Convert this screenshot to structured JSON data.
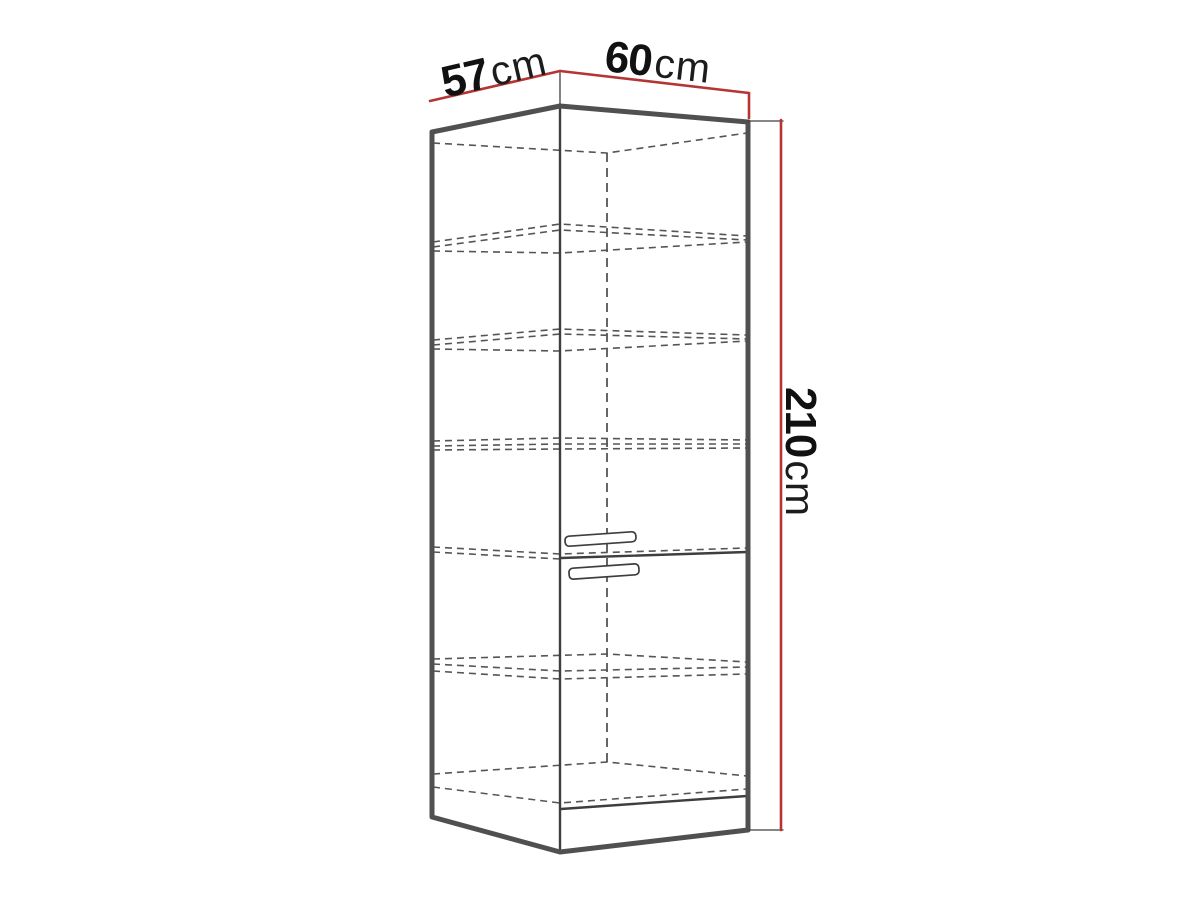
{
  "page": {
    "background": "#ffffff"
  },
  "diagram": {
    "type": "furniture-dimension-diagram",
    "subject": "tall corner cabinet wireframe drawing with shelves and two door handles",
    "dimensions": {
      "depth": {
        "value": "57",
        "unit": "cm"
      },
      "width": {
        "value": "60",
        "unit": "cm"
      },
      "height": {
        "value": "210",
        "unit": "cm"
      }
    },
    "colors": {
      "dimension_line": "#b53535",
      "outline": "#505050",
      "inner_line": "#3e3e3e",
      "dashed_line": "#555555",
      "label_text": "#111111",
      "background": "#ffffff"
    },
    "figure": {
      "canvas": {
        "w": 1200,
        "h": 900
      },
      "styles": {
        "fill": {
          "stroke": "none",
          "width": 0
        },
        "outline": {
          "stroke": "#505050",
          "width": 5
        },
        "edge": {
          "stroke": "#3e3e3e",
          "width": 2.4
        },
        "thin": {
          "stroke": "#3e3e3e",
          "width": 1.3
        },
        "dashed": {
          "stroke": "#555555",
          "width": 1.6,
          "dash": "7 5"
        },
        "dashedv": {
          "stroke": "#555555",
          "width": 1.8,
          "dash": "9 6"
        },
        "red": {
          "stroke": "#b53535",
          "width": 2.6
        }
      },
      "polylines": [
        {
          "name": "cabinet-face-fill",
          "style": "fill",
          "closed": true,
          "fill": "#ffffff",
          "points": [
            [
              432,
              132
            ],
            [
              560,
              106
            ],
            [
              748,
              122
            ],
            [
              748,
              830
            ],
            [
              560,
              852
            ],
            [
              432,
              817
            ]
          ]
        },
        {
          "name": "top-back-edge",
          "style": "dashed",
          "points": [
            [
              433,
              143
            ],
            [
              607,
              153
            ],
            [
              747,
              133
            ]
          ]
        },
        {
          "name": "back-corner-edge",
          "style": "dashedv",
          "points": [
            [
              607,
              153
            ],
            [
              607,
              762
            ]
          ]
        },
        {
          "name": "shelf-1-top-edge",
          "style": "dashed",
          "points": [
            [
              433,
              242
            ],
            [
              560,
              224
            ],
            [
              747,
              236
            ]
          ]
        },
        {
          "name": "shelf-1-back-edge",
          "style": "dashed",
          "points": [
            [
              433,
              247
            ],
            [
              560,
              230
            ],
            [
              747,
              240
            ]
          ]
        },
        {
          "name": "shelf-1-bottom-edge",
          "style": "dashed",
          "points": [
            [
              433,
              251
            ],
            [
              560,
              253
            ],
            [
              747,
              242
            ]
          ]
        },
        {
          "name": "shelf-2-top-edge",
          "style": "dashed",
          "points": [
            [
              433,
              340
            ],
            [
              560,
              329
            ],
            [
              747,
              335
            ]
          ]
        },
        {
          "name": "shelf-2-back-edge",
          "style": "dashed",
          "points": [
            [
              433,
              345
            ],
            [
              560,
              334
            ],
            [
              747,
              339
            ]
          ]
        },
        {
          "name": "shelf-2-bottom-edge",
          "style": "dashed",
          "points": [
            [
              433,
              349
            ],
            [
              560,
              351
            ],
            [
              747,
              341
            ]
          ]
        },
        {
          "name": "shelf-3-top-edge",
          "style": "dashed",
          "points": [
            [
              433,
              441
            ],
            [
              560,
              438
            ],
            [
              747,
              440
            ]
          ]
        },
        {
          "name": "shelf-3-back-edge",
          "style": "dashed",
          "points": [
            [
              433,
              446
            ],
            [
              560,
              444
            ],
            [
              747,
              444
            ]
          ]
        },
        {
          "name": "shelf-3-bottom-edge",
          "style": "dashed",
          "points": [
            [
              433,
              450
            ],
            [
              560,
              449
            ],
            [
              747,
              448
            ]
          ]
        },
        {
          "name": "divider-hidden-edge",
          "style": "dashed",
          "points": [
            [
              433,
              547
            ],
            [
              560,
              554
            ],
            [
              747,
              548
            ]
          ]
        },
        {
          "name": "divider-hidden-edge2",
          "style": "dashed",
          "points": [
            [
              433,
              552
            ],
            [
              560,
              559
            ]
          ]
        },
        {
          "name": "shelf-4-back-edge",
          "style": "dashed",
          "points": [
            [
              433,
              659
            ],
            [
              607,
              654
            ],
            [
              747,
              662
            ]
          ]
        },
        {
          "name": "shelf-4-top-edge",
          "style": "dashed",
          "points": [
            [
              433,
              664
            ],
            [
              560,
              671
            ],
            [
              747,
              667
            ]
          ]
        },
        {
          "name": "shelf-4-bottom-edge",
          "style": "dashed",
          "points": [
            [
              433,
              671
            ],
            [
              560,
              679
            ],
            [
              747,
              674
            ]
          ]
        },
        {
          "name": "floor-back-edge",
          "style": "dashed",
          "points": [
            [
              433,
              774
            ],
            [
              607,
              762
            ],
            [
              747,
              776
            ]
          ]
        },
        {
          "name": "floor-front-edge",
          "style": "dashed",
          "points": [
            [
              433,
              787
            ],
            [
              560,
              803
            ],
            [
              747,
              789
            ]
          ]
        },
        {
          "name": "door-split-line",
          "style": "edge",
          "points": [
            [
              561,
              558
            ],
            [
              747,
              552
            ]
          ]
        },
        {
          "name": "door-bottom-line",
          "style": "edge",
          "points": [
            [
              561,
              809
            ],
            [
              747,
              796
            ]
          ]
        },
        {
          "name": "front-corner-edge",
          "style": "edge",
          "points": [
            [
              560,
              106
            ],
            [
              560,
              852
            ]
          ]
        },
        {
          "name": "cabinet-outline",
          "style": "outline",
          "closed": true,
          "points": [
            [
              432,
              132
            ],
            [
              560,
              106
            ],
            [
              748,
              122
            ],
            [
              748,
              830
            ],
            [
              560,
              852
            ],
            [
              432,
              817
            ]
          ]
        },
        {
          "name": "apex-extension-line",
          "style": "thin",
          "points": [
            [
              560,
              73
            ],
            [
              560,
              104
            ]
          ]
        },
        {
          "name": "top-extension-line",
          "style": "thin",
          "points": [
            [
              748,
              121
            ],
            [
              783,
              121
            ]
          ]
        },
        {
          "name": "bottom-extension-line",
          "style": "thin",
          "points": [
            [
              750,
              830
            ],
            [
              783,
              830
            ]
          ]
        },
        {
          "name": "dim-line-depth-57",
          "style": "red",
          "points": [
            [
              430,
              101
            ],
            [
              560,
              71
            ]
          ]
        },
        {
          "name": "dim-line-width-60",
          "style": "red",
          "points": [
            [
              560,
              71
            ],
            [
              749,
              93
            ]
          ]
        },
        {
          "name": "dim-line-width-tick",
          "style": "red",
          "points": [
            [
              749,
              93
            ],
            [
              749,
              118
            ]
          ]
        },
        {
          "name": "dim-line-height-210",
          "style": "red",
          "points": [
            [
              781,
              120
            ],
            [
              781,
              830
            ]
          ]
        }
      ],
      "handles": [
        {
          "name": "upper-door-handle",
          "x": 565,
          "y": 534,
          "w": 71,
          "h": 10,
          "rx": 4,
          "rot": -4
        },
        {
          "name": "lower-door-handle",
          "x": 569,
          "y": 566,
          "w": 70,
          "h": 11,
          "rx": 4,
          "rot": -4
        }
      ]
    }
  }
}
